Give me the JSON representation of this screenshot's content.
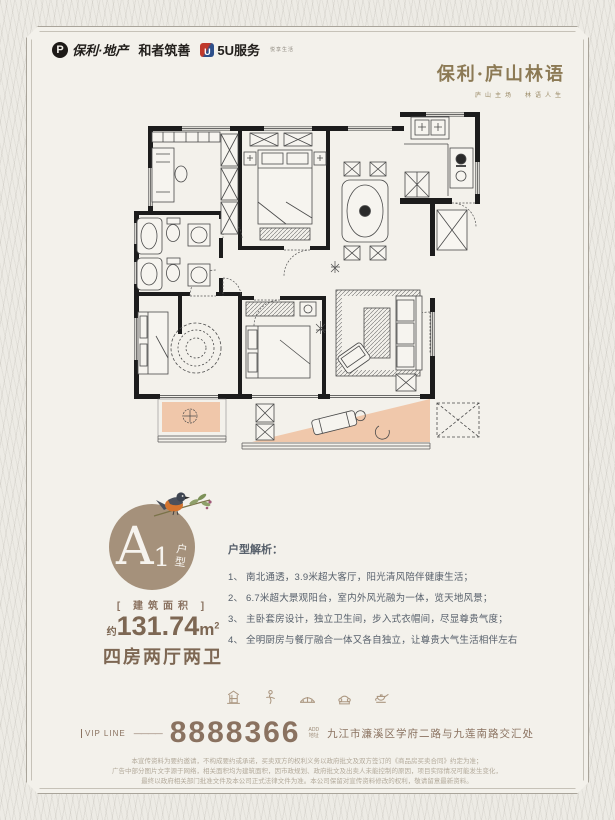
{
  "header": {
    "logo_poly_mark": "P",
    "logo_poly": "保利·地产",
    "logo_he": "和者筑善",
    "logo_5u_mark": "U",
    "logo_5u": "5U服务",
    "logo_5u_sub": "悦享生活",
    "brand": "保利·庐山林语",
    "brand_sub": "庐山主场　林语人生"
  },
  "unit": {
    "letter": "A",
    "number": "1",
    "suffix": "户型",
    "area_label": "[ 建筑面积 ]",
    "area_approx": "约",
    "area_value": "131.74",
    "area_unit": "m",
    "area_sup": "2",
    "layout": "四房两厅两卫"
  },
  "analysis": {
    "title": "户型解析：",
    "items": [
      "1、 南北通透，3.9米超大客厅，阳光清风陪伴健康生活；",
      "2、 6.7米超大景观阳台，室内外风光融为一体，览天地风景；",
      "3、 主卧套房设计，独立卫生间，步入式衣帽间，尽显尊贵气度；",
      "4、 全明厨房与餐厅融合一体又各自独立，让尊贵大气生活相伴左右"
    ]
  },
  "footer": {
    "vip_label": "VIP LINE",
    "vip_dash": "————",
    "phone": "8888366",
    "address_label_en": "ADD",
    "address_label": "地址",
    "address": "九江市濂溪区学府二路与九莲南路交汇处",
    "icons": [
      "pagoda-icon",
      "dancer-icon",
      "bridge-icon",
      "telephone-icon",
      "teapot-icon"
    ],
    "disclaimer": [
      "本宣传资料为要约邀请，不构成要约或承诺，买卖双方的权利义务以政府批文及双方签订的《商品房买卖合同》约定为准；",
      "广告中部分图片文字源于网络，相关面积均为建筑面积，因市政规划、政府批文及出卖人未能控制的原因，项目实际情况可能发生变化，",
      "最终以政府相关部门批准文件及本公司正式法律文件为准。本公司保留对宣传资料修改的权利，敬请留意最新资料。"
    ]
  },
  "colors": {
    "accent": "#8a7260",
    "badge": "#a5917b",
    "balcony_peach": "#f0c3a4",
    "ink": "#57606b"
  }
}
